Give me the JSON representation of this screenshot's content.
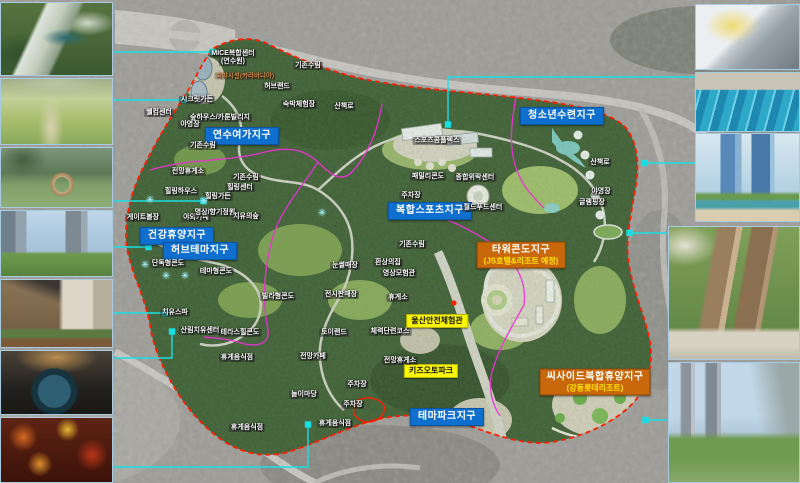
{
  "map": {
    "zone_labels": [
      {
        "type": "blue",
        "text": "연수여가지구",
        "x": 242,
        "y": 136
      },
      {
        "type": "blue",
        "text": "청소년수련지구",
        "x": 562,
        "y": 116
      },
      {
        "type": "blue",
        "text": "복합스포츠지구",
        "x": 430,
        "y": 211
      },
      {
        "type": "blue",
        "text": "건강휴양지구",
        "x": 177,
        "y": 236
      },
      {
        "type": "blue",
        "text": "허브테마지구",
        "x": 200,
        "y": 251
      },
      {
        "type": "blue",
        "text": "테마파크지구",
        "x": 447,
        "y": 417
      },
      {
        "type": "orange",
        "text": "타워콘도지구",
        "sub": "(JS호텔&리조트 예정)",
        "x": 521,
        "y": 255
      },
      {
        "type": "orange",
        "text": "씨사이드복합휴양지구",
        "sub": "(강동롯데리조트)",
        "x": 595,
        "y": 382
      }
    ],
    "poi_labels": [
      {
        "text": "울산안전체험관",
        "x": 437,
        "y": 321
      },
      {
        "text": "키즈오토파크",
        "x": 431,
        "y": 371
      }
    ],
    "facility_labels": [
      {
        "text": "MICE복합센터",
        "x": 233,
        "y": 54
      },
      {
        "text": "(연수원)",
        "x": 233,
        "y": 62
      },
      {
        "text": "숙박시설(카라바니아)",
        "x": 245,
        "y": 76,
        "variant": "amber"
      },
      {
        "text": "기존수림",
        "x": 308,
        "y": 66
      },
      {
        "text": "기존수림",
        "x": 203,
        "y": 146
      },
      {
        "text": "기존수림",
        "x": 246,
        "y": 178
      },
      {
        "text": "기존수림",
        "x": 412,
        "y": 245
      },
      {
        "text": "시크릿가든",
        "x": 197,
        "y": 100
      },
      {
        "text": "웰컴센터",
        "x": 159,
        "y": 113
      },
      {
        "text": "숲하우스/카룬빌리지",
        "x": 220,
        "y": 118
      },
      {
        "text": "야영장",
        "x": 190,
        "y": 125
      },
      {
        "text": "허브랜드",
        "x": 277,
        "y": 87
      },
      {
        "text": "숙박체험장",
        "x": 299,
        "y": 105
      },
      {
        "text": "산책로",
        "x": 344,
        "y": 107
      },
      {
        "text": "전망휴게소",
        "x": 188,
        "y": 172
      },
      {
        "text": "힐링하우스",
        "x": 181,
        "y": 192
      },
      {
        "text": "힐링센터",
        "x": 240,
        "y": 188
      },
      {
        "text": "힐링가든",
        "x": 218,
        "y": 197
      },
      {
        "text": "야외카페",
        "x": 196,
        "y": 218
      },
      {
        "text": "명상/향기정원",
        "x": 215,
        "y": 213
      },
      {
        "text": "치유의숲",
        "x": 246,
        "y": 217
      },
      {
        "text": "게이트볼장",
        "x": 143,
        "y": 218
      },
      {
        "text": "단독형콘도",
        "x": 168,
        "y": 264
      },
      {
        "text": "테마형콘도",
        "x": 216,
        "y": 272
      },
      {
        "text": "빌라형콘도",
        "x": 278,
        "y": 297
      },
      {
        "text": "치유스파",
        "x": 175,
        "y": 313
      },
      {
        "text": "산림치유센터",
        "x": 200,
        "y": 331
      },
      {
        "text": "테라스힐콘도",
        "x": 240,
        "y": 333
      },
      {
        "text": "스포츠콤플렉스",
        "x": 437,
        "y": 141
      },
      {
        "text": "패밀리콘도",
        "x": 428,
        "y": 177
      },
      {
        "text": "종합위락센터",
        "x": 475,
        "y": 178
      },
      {
        "text": "주차장",
        "x": 411,
        "y": 196
      },
      {
        "text": "월드푸드센터",
        "x": 483,
        "y": 208
      },
      {
        "text": "눈썰매장",
        "x": 345,
        "y": 266
      },
      {
        "text": "환상의집",
        "x": 388,
        "y": 263
      },
      {
        "text": "영상모험관",
        "x": 399,
        "y": 274
      },
      {
        "text": "전시판매장",
        "x": 341,
        "y": 295
      },
      {
        "text": "휴게소",
        "x": 398,
        "y": 298
      },
      {
        "text": "토이랜드",
        "x": 334,
        "y": 333
      },
      {
        "text": "체력단련코스",
        "x": 390,
        "y": 332
      },
      {
        "text": "전망휴게소",
        "x": 400,
        "y": 361
      },
      {
        "text": "주차장",
        "x": 357,
        "y": 385
      },
      {
        "text": "주차장",
        "x": 353,
        "y": 405
      },
      {
        "text": "휴게음식점",
        "x": 237,
        "y": 358
      },
      {
        "text": "전망카페",
        "x": 313,
        "y": 357
      },
      {
        "text": "놀이마당",
        "x": 304,
        "y": 395
      },
      {
        "text": "휴게음식점",
        "x": 247,
        "y": 428
      },
      {
        "text": "휴게음식점",
        "x": 335,
        "y": 424
      },
      {
        "text": "산책로",
        "x": 600,
        "y": 163
      },
      {
        "text": "야영장",
        "x": 601,
        "y": 192
      },
      {
        "text": "글램핑장",
        "x": 592,
        "y": 203
      }
    ],
    "sparkle_markers": [
      {
        "x": 150,
        "y": 200
      },
      {
        "x": 204,
        "y": 201
      },
      {
        "x": 145,
        "y": 265
      },
      {
        "x": 166,
        "y": 276
      },
      {
        "x": 185,
        "y": 276
      },
      {
        "x": 322,
        "y": 213
      }
    ],
    "colors": {
      "zone_blue": "#0e6fce",
      "zone_orange": "#c8680a",
      "zone_sub_yellow": "#ffe500",
      "poi_yellow": "#fdf800",
      "boundary_red": "#ff1e00",
      "district_magenta": "#f02fd8",
      "connector_cyan": "#19dfe4"
    }
  },
  "photos": {
    "left": [
      {
        "id": "l1",
        "subject": "resort-hotel-aerial-render"
      },
      {
        "id": "l2",
        "subject": "garden-path-flower-field"
      },
      {
        "id": "l3",
        "subject": "park-lawn-wood-sculpture"
      },
      {
        "id": "l4",
        "subject": "hotel-towers-landscape"
      },
      {
        "id": "l5",
        "subject": "modern-villa-patio"
      },
      {
        "id": "l6",
        "subject": "round-spa-pool"
      },
      {
        "id": "l7",
        "subject": "festive-market-interior"
      }
    ],
    "right": [
      {
        "id": "r1",
        "subject": "indoor-ski-slope"
      },
      {
        "id": "r2",
        "subject": "indoor-swimming-pool"
      },
      {
        "id": "r3",
        "subject": "glass-tower-resort-render"
      },
      {
        "id": "r4",
        "subject": "tower-condo-aerial-render"
      },
      {
        "id": "r5",
        "subject": "seaside-resort-complex-render"
      }
    ]
  }
}
